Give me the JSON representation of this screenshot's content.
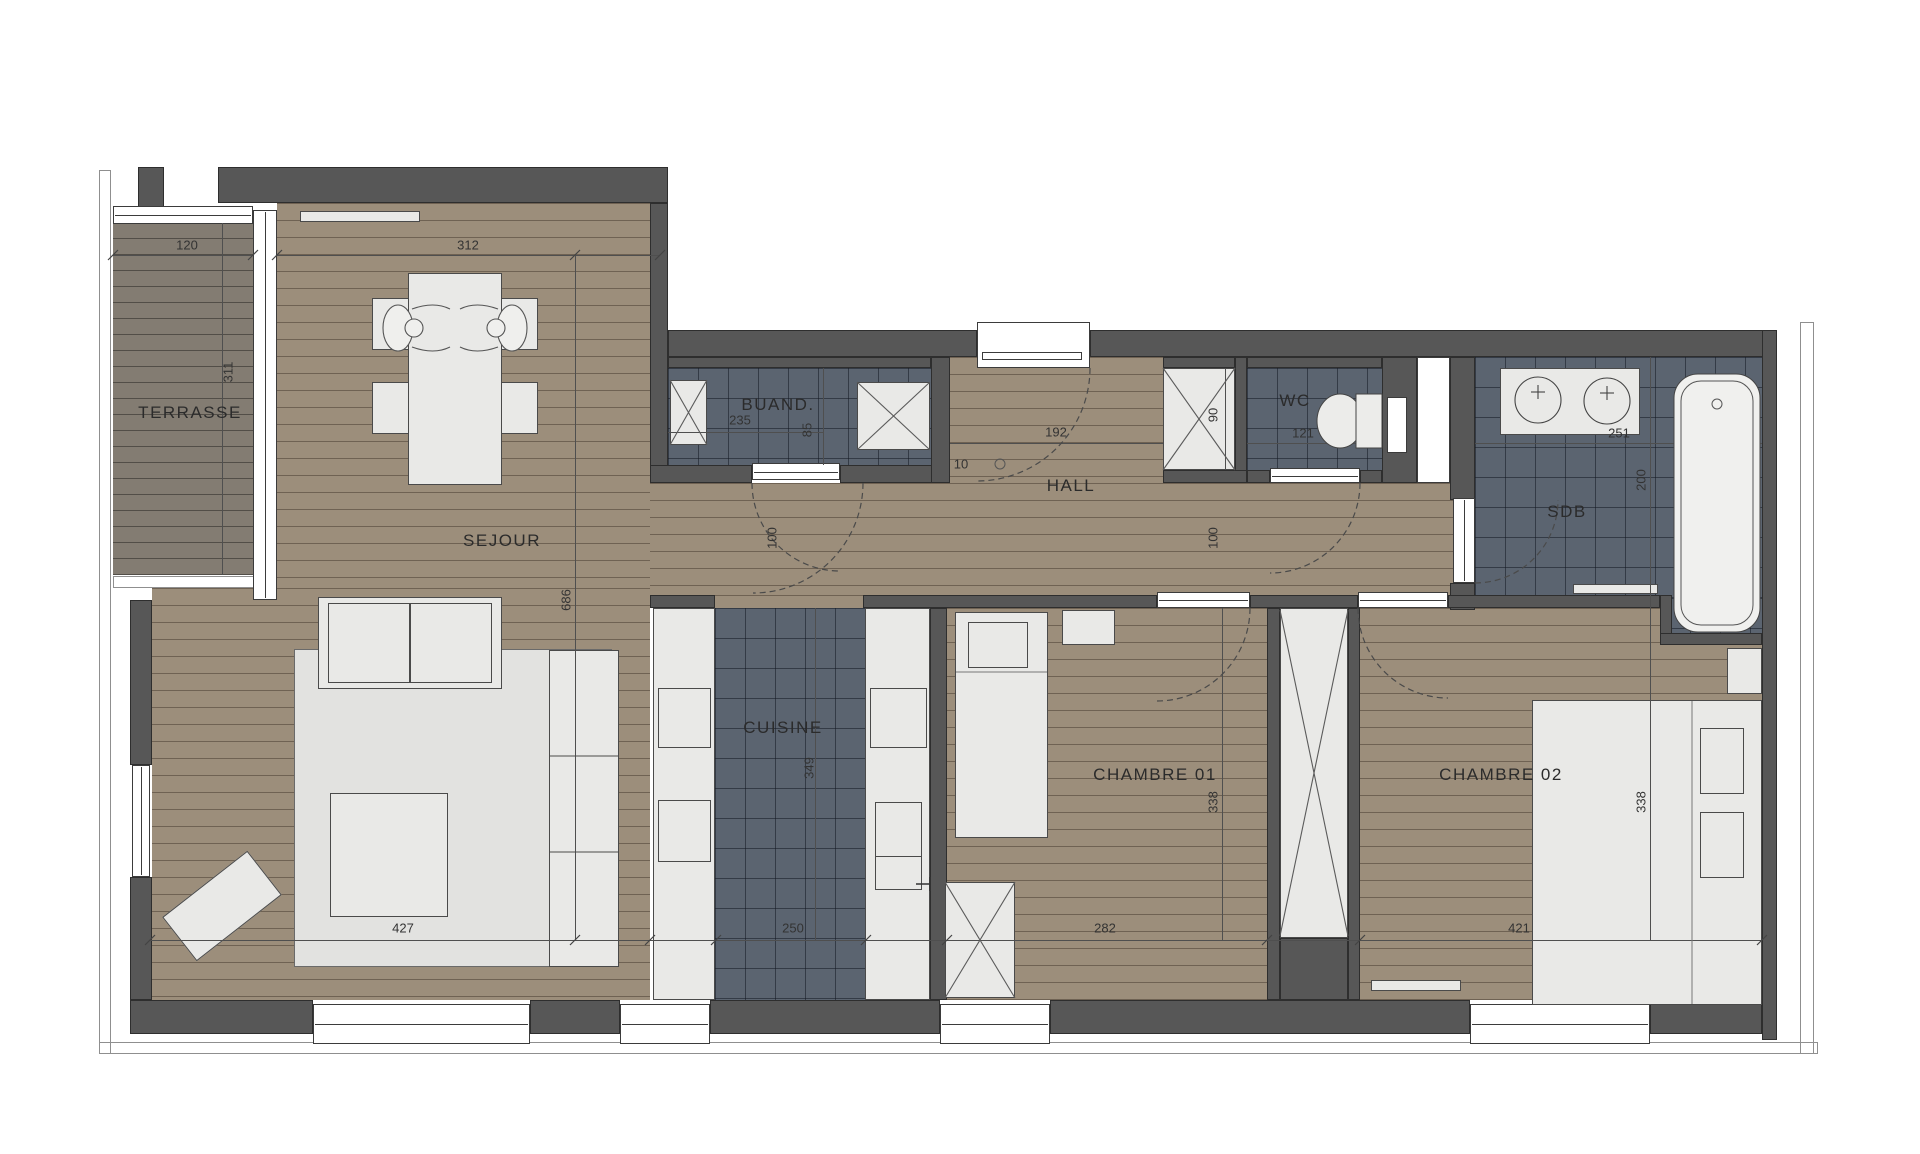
{
  "plan": {
    "title": "Apartment floor plan",
    "rooms": [
      {
        "label": "TERRASSE",
        "x": 190,
        "y": 413
      },
      {
        "label": "SEJOUR",
        "x": 502,
        "y": 541
      },
      {
        "label": "BUAND.",
        "x": 778,
        "y": 405
      },
      {
        "label": "HALL",
        "x": 1071,
        "y": 486
      },
      {
        "label": "WC",
        "x": 1295,
        "y": 401
      },
      {
        "label": "SDB",
        "x": 1567,
        "y": 512
      },
      {
        "label": "CUISINE",
        "x": 783,
        "y": 728
      },
      {
        "label": "CHAMBRE 01",
        "x": 1155,
        "y": 775
      },
      {
        "label": "CHAMBRE 02",
        "x": 1501,
        "y": 775
      }
    ],
    "dimensions": [
      {
        "text": "120",
        "x": 187,
        "y": 245
      },
      {
        "text": "312",
        "x": 468,
        "y": 245
      },
      {
        "text": "311",
        "x": 228,
        "y": 372,
        "v": true
      },
      {
        "text": "686",
        "x": 566,
        "y": 600,
        "v": true
      },
      {
        "text": "235",
        "x": 740,
        "y": 420
      },
      {
        "text": "85",
        "x": 807,
        "y": 430,
        "v": true
      },
      {
        "text": "10",
        "x": 961,
        "y": 464
      },
      {
        "text": "192",
        "x": 1056,
        "y": 432
      },
      {
        "text": "90",
        "x": 1213,
        "y": 415,
        "v": true
      },
      {
        "text": "121",
        "x": 1303,
        "y": 433
      },
      {
        "text": "251",
        "x": 1619,
        "y": 433
      },
      {
        "text": "200",
        "x": 1641,
        "y": 480,
        "v": true
      },
      {
        "text": "100",
        "x": 772,
        "y": 538,
        "v": true
      },
      {
        "text": "100",
        "x": 1213,
        "y": 538,
        "v": true
      },
      {
        "text": "349",
        "x": 809,
        "y": 768,
        "v": true
      },
      {
        "text": "338",
        "x": 1213,
        "y": 802,
        "v": true
      },
      {
        "text": "338",
        "x": 1641,
        "y": 802,
        "v": true
      },
      {
        "text": "427",
        "x": 403,
        "y": 928
      },
      {
        "text": "250",
        "x": 793,
        "y": 928
      },
      {
        "text": "282",
        "x": 1105,
        "y": 928
      },
      {
        "text": "421",
        "x": 1519,
        "y": 928
      }
    ],
    "colors": {
      "wall": "#575757",
      "wood": "#9c8e7b",
      "deck": "#837c72",
      "tile": "#5b6470",
      "furniture": "#e9e9e7",
      "rug": "#e2e2e0",
      "label": "#2b2b2b"
    }
  }
}
